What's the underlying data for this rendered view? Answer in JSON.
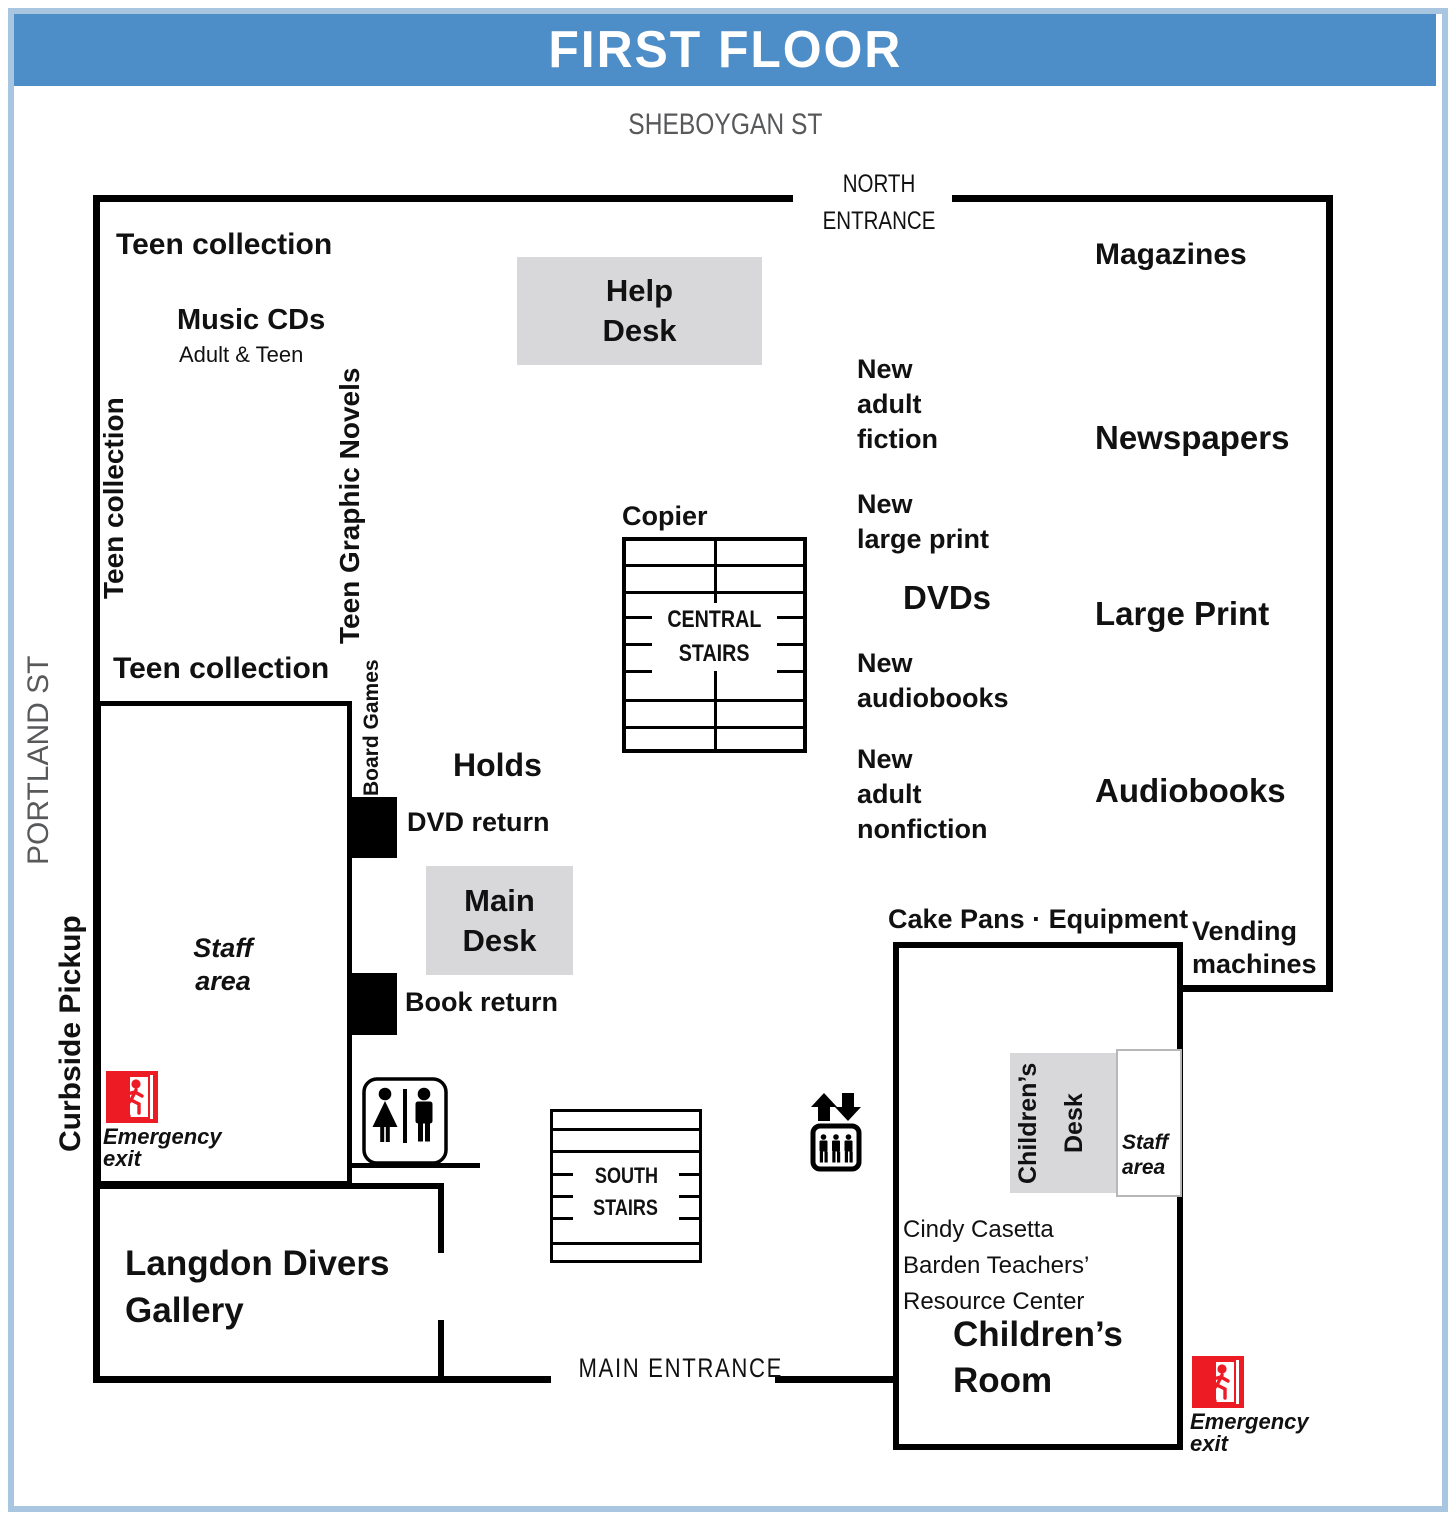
{
  "title": "FIRST FLOOR",
  "streets": {
    "top": "SHEBOYGAN ST",
    "left": "PORTLAND ST"
  },
  "entrances": {
    "north": [
      "NORTH",
      "ENTRANCE"
    ],
    "main": "MAIN ENTRANCE"
  },
  "stairs": {
    "central": [
      "CENTRAL",
      "STAIRS"
    ],
    "south": [
      "SOUTH",
      "STAIRS"
    ]
  },
  "areas": {
    "teen_collection_top": "Teen collection",
    "music_cds": "Music CDs",
    "music_cds_sub": "Adult & Teen",
    "teen_collection_left": "Teen collection",
    "teen_graphic_novels": "Teen Graphic Novels",
    "teen_collection_lower": "Teen collection",
    "board_games": "Board Games",
    "help_desk": [
      "Help",
      "Desk"
    ],
    "magazines": "Magazines",
    "new_adult_fiction": [
      "New",
      "adult",
      "fiction"
    ],
    "newspapers": "Newspapers",
    "new_large_print": [
      "New",
      "large print"
    ],
    "dvds": "DVDs",
    "large_print": "Large Print",
    "new_audiobooks": [
      "New",
      "audiobooks"
    ],
    "new_adult_nonfiction": [
      "New",
      "adult",
      "nonfiction"
    ],
    "audiobooks": "Audiobooks",
    "copier": "Copier",
    "holds": "Holds",
    "dvd_return": "DVD return",
    "book_return": "Book return",
    "main_desk": [
      "Main",
      "Desk"
    ],
    "staff_area": [
      "Staff",
      "area"
    ],
    "curbside_pickup": "Curbside Pickup",
    "emergency_exit": [
      "Emergency",
      "exit"
    ],
    "cake_pans_equipment": "Cake Pans · Equipment",
    "vending_machines": [
      "Vending",
      "machines"
    ],
    "childrens_desk": [
      "Children’s",
      "Desk"
    ],
    "staff_area_right": [
      "Staff",
      "area"
    ],
    "teachers_center": [
      "Cindy Casetta",
      "Barden Teachers’",
      "Resource Center"
    ],
    "childrens_room": [
      "Children’s",
      "Room"
    ],
    "langdon_gallery": [
      "Langdon Divers",
      "Gallery"
    ]
  },
  "icons": {
    "restroom": "restroom",
    "elevator": "elevator",
    "emergency_exit": "emergency-exit"
  },
  "colors": {
    "header_blue": "#4d8dc8",
    "border_blue": "#a9c6e0",
    "desk_gray": "#d8d8da",
    "exit_red": "#ed1c24",
    "street_gray": "#58595b"
  }
}
